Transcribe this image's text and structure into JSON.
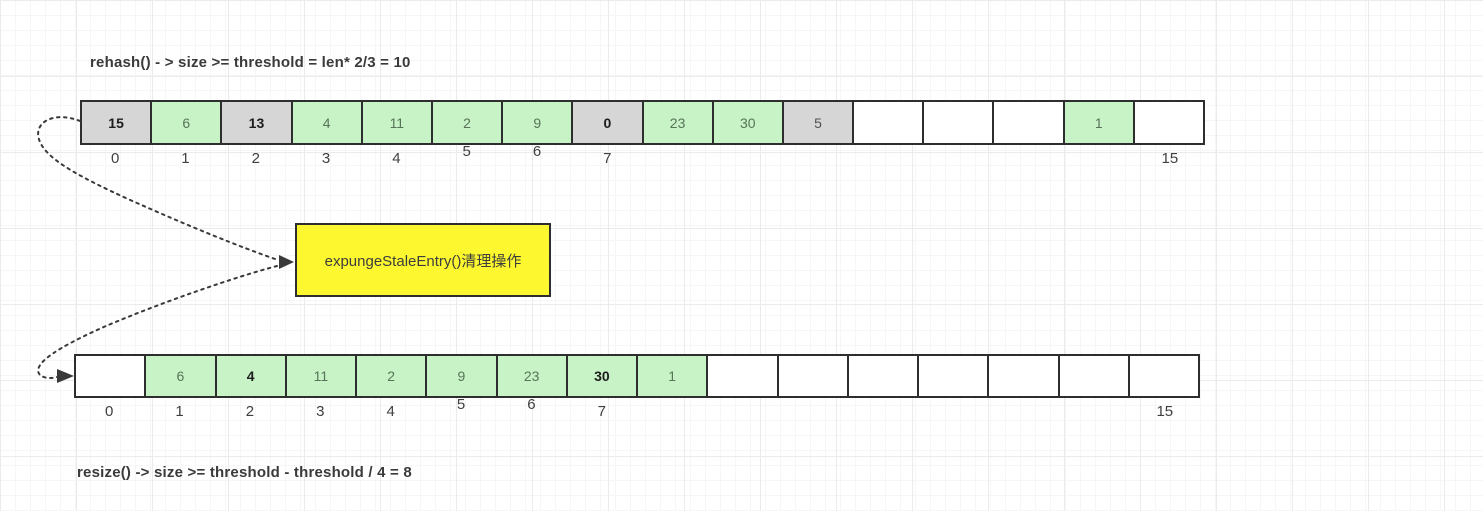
{
  "titles": {
    "top": "rehash() - > size >= threshold = len* 2/3 = 10",
    "bottom": "resize() -> size >= threshold - threshold / 4 = 8"
  },
  "expunge_box": {
    "label": "expungeStaleEntry()清理操作"
  },
  "colors": {
    "gray": "#d6d6d6",
    "green": "#c7f3c7",
    "yellow": "#fcf72e",
    "border": "#2e2e2e",
    "arrow": "#3a3a3a"
  },
  "top_array": {
    "cells": [
      {
        "value": "15",
        "color": "gray",
        "bold": true,
        "label": "0"
      },
      {
        "value": "6",
        "color": "green",
        "bold": false,
        "label": "1"
      },
      {
        "value": "13",
        "color": "gray",
        "bold": true,
        "label": "2"
      },
      {
        "value": "4",
        "color": "green",
        "bold": false,
        "label": "3"
      },
      {
        "value": "11",
        "color": "green",
        "bold": false,
        "label": "4"
      },
      {
        "value": "2",
        "color": "green",
        "bold": false,
        "label": "5"
      },
      {
        "value": "9",
        "color": "green",
        "bold": false,
        "label": "6"
      },
      {
        "value": "0",
        "color": "gray",
        "bold": true,
        "label": "7"
      },
      {
        "value": "23",
        "color": "green",
        "bold": false,
        "label": ""
      },
      {
        "value": "30",
        "color": "green",
        "bold": false,
        "label": ""
      },
      {
        "value": "5",
        "color": "gray",
        "bold": false,
        "label": ""
      },
      {
        "value": "",
        "color": "white",
        "bold": false,
        "label": ""
      },
      {
        "value": "",
        "color": "white",
        "bold": false,
        "label": ""
      },
      {
        "value": "",
        "color": "white",
        "bold": false,
        "label": ""
      },
      {
        "value": "1",
        "color": "green",
        "bold": false,
        "label": ""
      },
      {
        "value": "",
        "color": "white",
        "bold": false,
        "label": "15"
      }
    ]
  },
  "bottom_array": {
    "cells": [
      {
        "value": "",
        "color": "white",
        "bold": false,
        "label": "0"
      },
      {
        "value": "6",
        "color": "green",
        "bold": false,
        "label": "1"
      },
      {
        "value": "4",
        "color": "green",
        "bold": true,
        "label": "2"
      },
      {
        "value": "11",
        "color": "green",
        "bold": false,
        "label": "3"
      },
      {
        "value": "2",
        "color": "green",
        "bold": false,
        "label": "4"
      },
      {
        "value": "9",
        "color": "green",
        "bold": false,
        "label": "5"
      },
      {
        "value": "23",
        "color": "green",
        "bold": false,
        "label": "6"
      },
      {
        "value": "30",
        "color": "green",
        "bold": true,
        "label": "7"
      },
      {
        "value": "1",
        "color": "green",
        "bold": false,
        "label": ""
      },
      {
        "value": "",
        "color": "white",
        "bold": false,
        "label": ""
      },
      {
        "value": "",
        "color": "white",
        "bold": false,
        "label": ""
      },
      {
        "value": "",
        "color": "white",
        "bold": false,
        "label": ""
      },
      {
        "value": "",
        "color": "white",
        "bold": false,
        "label": ""
      },
      {
        "value": "",
        "color": "white",
        "bold": false,
        "label": ""
      },
      {
        "value": "",
        "color": "white",
        "bold": false,
        "label": ""
      },
      {
        "value": "",
        "color": "white",
        "bold": false,
        "label": "15"
      }
    ]
  }
}
